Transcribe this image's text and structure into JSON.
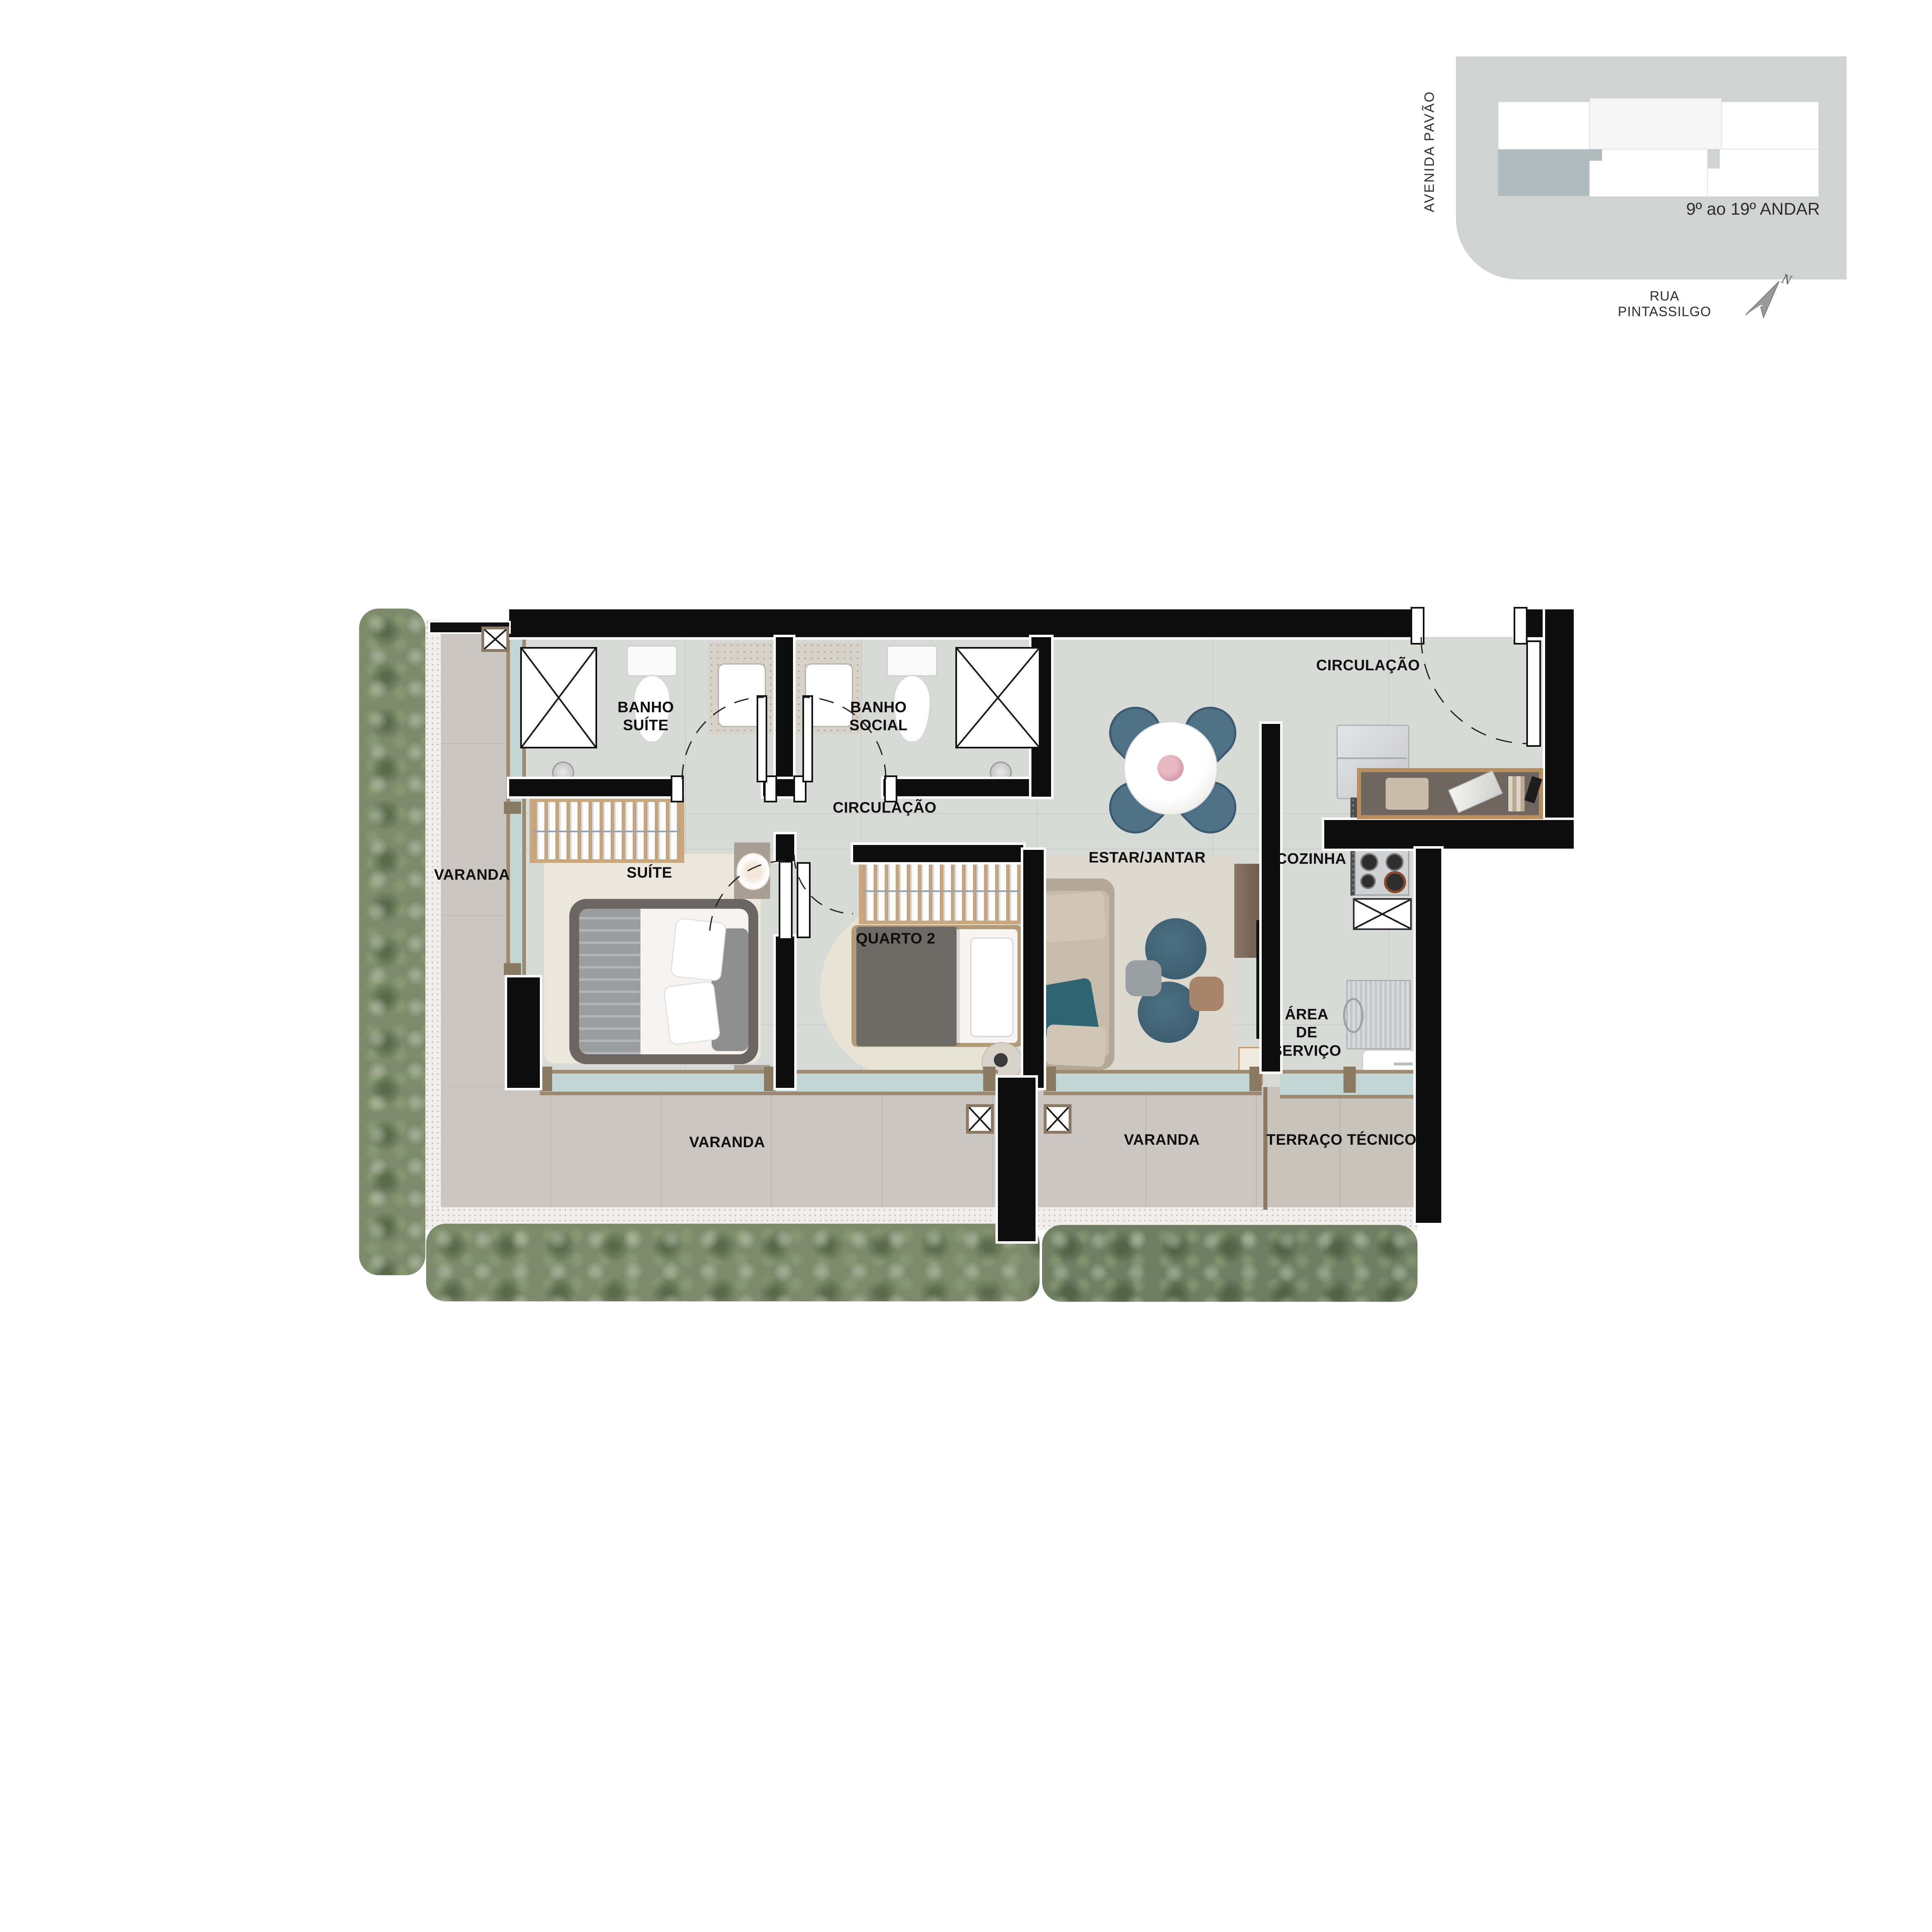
{
  "key_plan": {
    "avenue_label": "AVENIDA PAVÃO",
    "street_label": "RUA PINTASSILGO",
    "floors_label": "9º  ao 19º ANDAR",
    "north_letter": "N",
    "highlight_color": "#aebcc0",
    "block_color": "#d1d2d2",
    "unit_light_color": "#f6f6f6"
  },
  "plan": {
    "labels": {
      "banho_suite": "BANHO\nSUÍTE",
      "banho_social": "BANHO\nSOCIAL",
      "circulacao_entry": "CIRCULAÇÃO",
      "circulacao_internal": "CIRCULAÇÃO",
      "suite": "SUÍTE",
      "quarto2": "QUARTO 2",
      "estar_jantar": "ESTAR/JANTAR",
      "cozinha": "COZINHA",
      "area_servico": "ÁREA\nDE\nSERVIÇO",
      "varanda_left": "VARANDA",
      "varanda_bottom_left": "VARANDA",
      "varanda_bottom_right": "VARANDA",
      "terraco_tecnico": "TERRAÇO TÉCNICO"
    },
    "colors": {
      "wall": "#0d0d0d",
      "interior_floor": "#d8dad7",
      "varanda_floor": "#cbc7c0",
      "window_frame": "#9d8a71",
      "glass": "#c2d6d6",
      "hedge": "#7d8b6c",
      "hedge_dark": "#6e7f63",
      "gravel": "#efeeea",
      "granite_dark": "#4f4f52",
      "sofa_beige": "#b3a897",
      "accent_teal": "#2f6472",
      "chair_blue": "#4e7187",
      "wood": "#b98e5f"
    }
  }
}
